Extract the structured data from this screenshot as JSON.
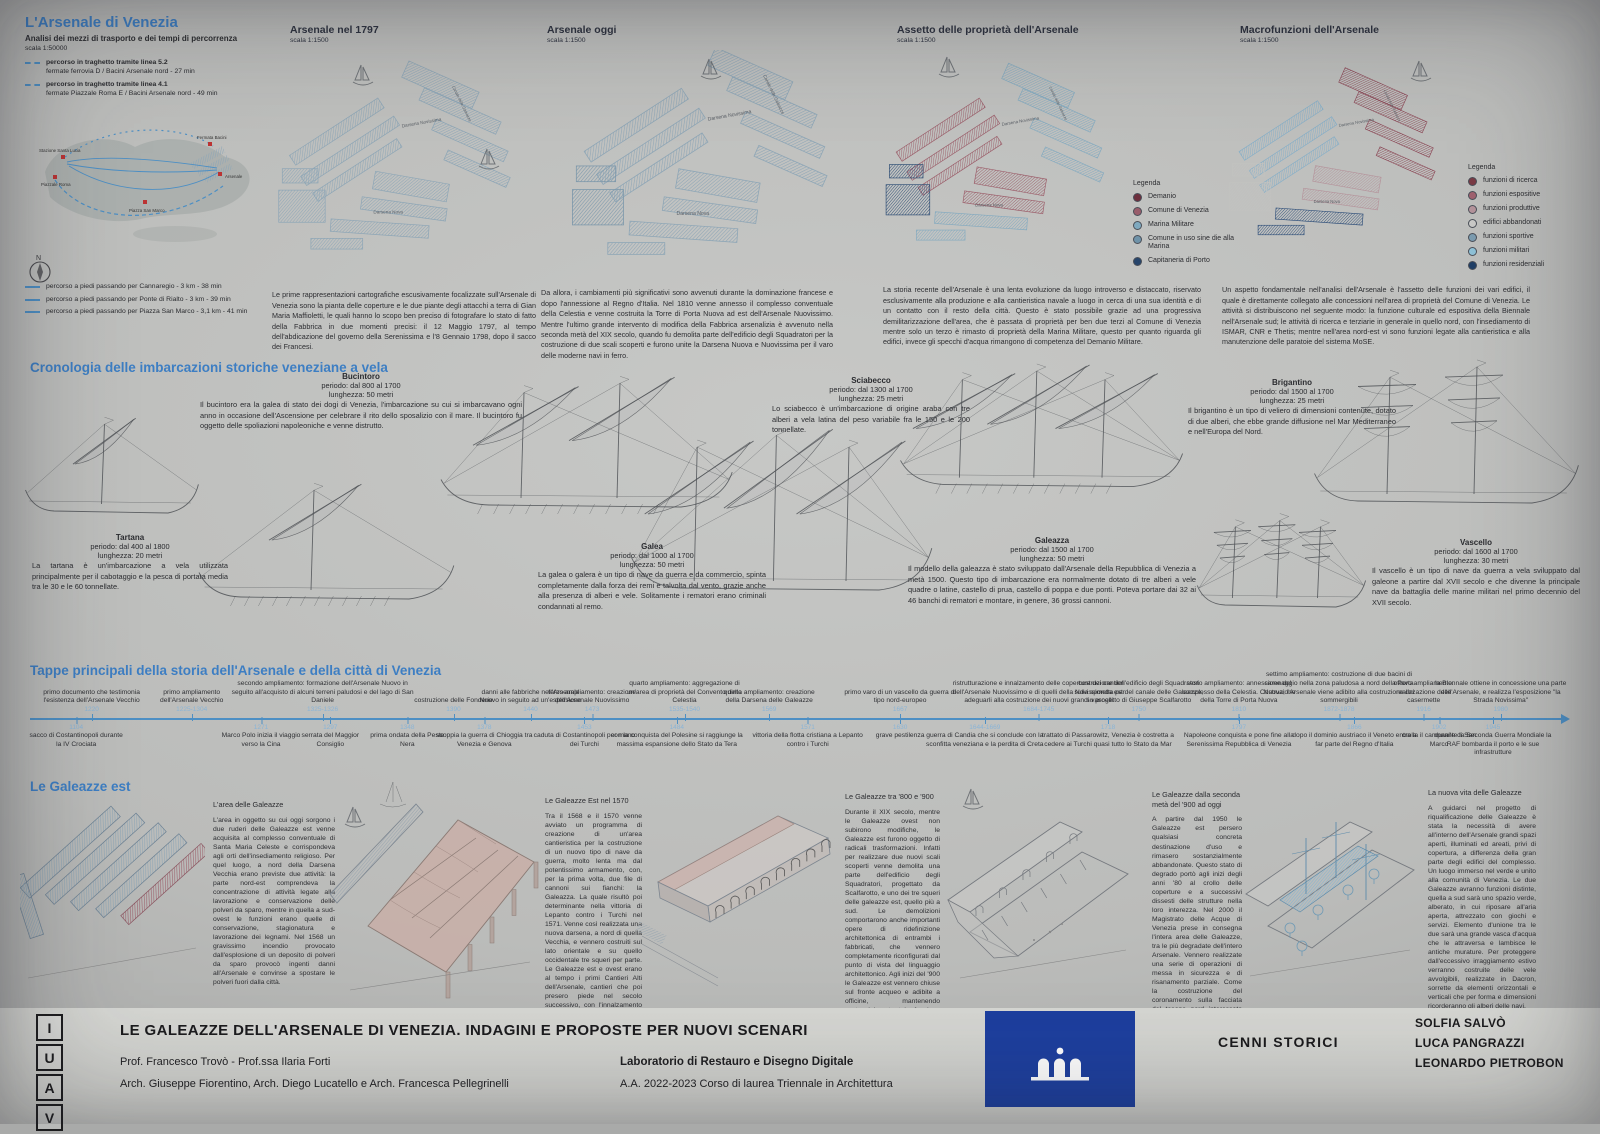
{
  "colors": {
    "accent": "#3d7ec3",
    "timeline": "#4d8fc4",
    "date": "#8ab4d6"
  },
  "transit": {
    "title": "L'Arsenale di Venezia",
    "subtitle": "Analisi dei mezzi di trasporto e dei tempi di percorrenza",
    "scale": "scala 1:50000",
    "ferry_routes": [
      {
        "label": "percorso in traghetto tramite linea 5.2",
        "detail": "fermate ferrovia D / Bacini Arsenale nord - 27 min"
      },
      {
        "label": "percorso in traghetto tramite linea 4.1",
        "detail": "fermate Piazzale Roma E / Bacini Arsenale nord - 49 min"
      }
    ],
    "walk_routes": [
      "percorso a piedi passando per Cannaregio - 3 km - 38 min",
      "percorso a piedi passando per Ponte di Rialto - 3 km - 39 min",
      "percorso a piedi passando per Piazza San Marco - 3,1 km - 41 min"
    ],
    "map_labels": [
      "Stazione Santa Lucia",
      "Piazzale Roma",
      "Piazza San Marco",
      "Fermata Bacini",
      "Arsenale"
    ],
    "compass_label": "N"
  },
  "map_annotations": {
    "water": [
      "Darsena Novissima",
      "Darsena Nova",
      "Canale delle Galeazze"
    ]
  },
  "maps": [
    {
      "title": "Arsenale nel 1797",
      "scale": "scala 1:1500",
      "caption": "Le prime rappresentazioni cartografiche escusivamente focalizzate sull'Arsenale di Venezia sono la pianta delle coperture e le due piante degli attacchi a terra di Gian Maria Maffioletti, le quali hanno lo scopo ben preciso di fotografare lo stato di fatto della Fabbrica in due momenti precisi: il 12 Maggio 1797, al tempo dell'abdicazione del governo della Serenissima e l'8 Gennaio 1798, dopo il sacco dei Francesi."
    },
    {
      "title": "Arsenale oggi",
      "scale": "scala 1:1500",
      "caption": "Da allora, i cambiamenti più significativi sono avvenuti durante la dominazione francese e dopo l'annessione al Regno d'Italia. Nel 1810 venne annesso il complesso conventuale della Celestia e venne costruita la Torre di Porta Nuova ad est dell'Arsenale Nuovissimo. Mentre l'ultimo grande intervento di modifica della Fabbrica arsenalizia è avvenuto nella seconda metà del XIX secolo, quando fu demolita parte dell'edificio degli Squadratori per la costruzione di due scali scoperti e furono unite la Darsena Nuova e Nuovissima per il varo delle moderne navi in ferro."
    },
    {
      "title": "Assetto delle proprietà dell'Arsenale",
      "scale": "scala 1:1500",
      "caption": "La storia recente dell'Arsenale è una lenta evoluzione da luogo introverso e distaccato, riservato esclusivamente alla produzione e alla cantieristica navale a luogo in cerca di una sua identità e di un contatto con il resto della città. Questo è stato possibile grazie ad una progressiva demilitarizzazione dell'area, che è passata di proprietà per ben due terzi al Comune di Venezia mentre solo un terzo è rimasto di proprietà della Marina Militare, questo per quanto riguarda gli edifici, invece gli specchi d'acqua rimangono di competenza del Demanio Militare.",
      "legend": {
        "title": "Legenda",
        "items": [
          {
            "label": "Demanio",
            "color": "#6d2f3d"
          },
          {
            "label": "Comune di Venezia",
            "color": "#995d6b"
          },
          {
            "label": "Marina Militare",
            "color": "#7fa9bf"
          },
          {
            "label": "Comune in uso sine die alla Marina",
            "color": "#6f93a9"
          },
          {
            "label": "Capitaneria di Porto",
            "color": "#27456b"
          }
        ]
      }
    },
    {
      "title": "Macrofunzioni dell'Arsenale",
      "scale": "scala 1:1500",
      "caption": "Un aspetto fondamentale nell'analisi dell'Arsenale è l'assetto delle funzioni dei vari edifici, il quale è direttamente collegato alle concessioni nell'area di proprietà del Comune di Venezia. Le attività si distribuiscono nel seguente modo: la funzione culturale ed espositiva della Biennale nell'Arsenale sud; le attività di ricerca e terziarie in generale in quello nord, con l'insediamento di ISMAR, CNR e Thetis; mentre nell'area nord-est vi sono funzioni legate alla cantieristica e alla manutenzione delle paratoie del sistema MoSE.",
      "legend": {
        "title": "Legenda",
        "items": [
          {
            "label": "funzioni di ricerca",
            "color": "#7a3b45"
          },
          {
            "label": "funzioni espositive",
            "color": "#a0616f"
          },
          {
            "label": "funzioni produttive",
            "color": "#b4939b"
          },
          {
            "label": "edifici abbandonati",
            "color": "#c9c9c7"
          },
          {
            "label": "funzioni sportive",
            "color": "#7b9cb0"
          },
          {
            "label": "funzioni militari",
            "color": "#8fc2d8"
          },
          {
            "label": "funzioni residenziali",
            "color": "#203f66"
          }
        ]
      }
    }
  ],
  "ships_section": {
    "title": "Cronologia delle imbarcazioni storiche veneziane a vela",
    "ships": [
      {
        "name": "Bucintoro",
        "period": "periodo: dal 800 al 1700",
        "length": "lunghezza: 50 metri",
        "desc": "Il bucintoro era la galea di stato dei dogi di Venezia, l'imbarcazione su cui si imbarcavano ogni anno in occasione dell'Ascensione per celebrare il rito dello sposalizio con il mare. Il bucintoro fu oggetto delle spoliazioni napoleoniche e venne distrutto."
      },
      {
        "name": "Sciabecco",
        "period": "periodo: dal 1300 al 1700",
        "length": "lunghezza: 25 metri",
        "desc": "Lo sciabecco è un'imbarcazione di origine araba con tre alberi a vela latina del peso variabile fra le 150 e le 200 tonnellate."
      },
      {
        "name": "Brigantino",
        "period": "periodo: dal 1500 al 1700",
        "length": "lunghezza: 25 metri",
        "desc": "Il brigantino è un tipo di veliero di dimensioni contenute, dotato di due alberi, che ebbe grande diffusione nel Mar Mediterraneo e nell'Europa del Nord."
      },
      {
        "name": "Tartana",
        "period": "periodo: dal 400 al 1800",
        "length": "lunghezza: 20 metri",
        "desc": "La tartana è un'imbarcazione a vela utilizzata principalmente per il cabotaggio e la pesca di portata media tra le 30 e le 60 tonnellate."
      },
      {
        "name": "Galea",
        "period": "periodo: dal 1000 al 1700",
        "length": "lunghezza: 50 metri",
        "desc": "La galea o galera è un tipo di nave da guerra e da commercio, spinta completamente dalla forza dei remi e talvolta dal vento, grazie anche alla presenza di alberi e vele. Solitamente i rematori erano criminali condannati al remo."
      },
      {
        "name": "Galeazza",
        "period": "periodo: dal 1500 al 1700",
        "length": "lunghezza: 50 metri",
        "desc": "Il modello della galeazza è stato sviluppato dall'Arsenale della Repubblica di Venezia a metà 1500. Questo tipo di imbarcazione era normalmente dotato di tre alberi a vele quadre o latine, castello di prua, castello di poppa e due ponti. Poteva portare dai 32 ai 46 banchi di rematori e montare, in genere, 36 grossi cannoni."
      },
      {
        "name": "Vascello",
        "period": "periodo: dal 1600 al 1700",
        "length": "lunghezza: 30 metri",
        "desc": "Il vascello è un tipo di nave da guerra a vela sviluppato dal galeone a partire dal XVII secolo e che divenne la principale nave da battaglia delle marine militari nel primo decennio del XVII secolo."
      }
    ]
  },
  "timeline": {
    "title": "Tappe principali della storia dell'Arsenale e della città di Venezia",
    "events_above": [
      {
        "date": "1220",
        "label": "primo documento che testimonia l'esistenza dell'Arsenale Vecchio",
        "x_pct": 4,
        "w": 100
      },
      {
        "date": "1225-1304",
        "label": "primo ampliamento dell'Arsenale Vecchio",
        "x_pct": 10.5,
        "w": 80
      },
      {
        "date": "1325-1326",
        "label": "secondo ampliamento: formazione dell'Arsenale Nuovo in seguito all'acquisto di alcuni terreni paludosi e del lago di San Daniele",
        "x_pct": 19,
        "w": 190
      },
      {
        "date": "1390",
        "label": "costruzione delle Fonderie",
        "x_pct": 27.5,
        "w": 80
      },
      {
        "date": "1440",
        "label": "danni alle fabbriche nell'Arsenale Nuovo in seguito ad un'esplosione",
        "x_pct": 32.5,
        "w": 110
      },
      {
        "date": "1473",
        "label": "terzo ampliamento: creazione dell'Arsenale Nuovissimo",
        "x_pct": 36.5,
        "w": 95
      },
      {
        "date": "1535-1540",
        "label": "quarto ampliamento: aggregazione di un'area di proprietà del Convento della Celestia",
        "x_pct": 42.5,
        "w": 130
      },
      {
        "date": "1569",
        "label": "quinto ampliamento: creazione della Darsena delle Galeazze",
        "x_pct": 48,
        "w": 100
      },
      {
        "date": "1667",
        "label": "primo varo di un vascello da guerra di tipo nord-europeo",
        "x_pct": 56.5,
        "w": 120
      },
      {
        "date": "1684-1745",
        "label": "ristrutturazione e innalzamento delle coperture dei cantieri dell'Arsenale Nuovissimo e di quelli della Novissimetta per adeguarli alla costruzione dei nuovi grandi vascelli",
        "x_pct": 65.5,
        "w": 175
      },
      {
        "date": "1750",
        "label": "costruzione dell'edificio degli Squadratori sulla sponda est del canale delle Galeazze, su progetto di Giuseppe Scalfarotto",
        "x_pct": 72,
        "w": 135
      },
      {
        "date": "1810",
        "label": "sesto ampliamento: annessione del complesso della Celestia. Costruzione della Torre di Porta Nuova",
        "x_pct": 78.5,
        "w": 115
      },
      {
        "date": "1872-1878",
        "label": "settimo ampliamento: costruzione di due bacini di carenaggio nella zona paludosa a nord della Porta Nuova; l'Arsenale viene adibito alla costruzione dei sommergibili",
        "x_pct": 85,
        "w": 155
      },
      {
        "date": "1916",
        "label": "ottavo ampliamento: realizzazione delle casermette",
        "x_pct": 90.5,
        "w": 85
      },
      {
        "date": "1980",
        "label": "la Biennale ottiene in concessione una parte dell'Arsenale, e realizza l'esposizione \"la Strada Novissima\"",
        "x_pct": 95.5,
        "w": 140
      }
    ],
    "events_below": [
      {
        "date": "1104",
        "label": "sacco di Costantinopoli durante la IV Crociata",
        "x_pct": 3,
        "w": 95
      },
      {
        "date": "1271",
        "label": "Marco Polo inizia il viaggio verso la Cina",
        "x_pct": 15,
        "w": 85
      },
      {
        "date": "1297",
        "label": "serrata del Maggior Consiglio",
        "x_pct": 19.5,
        "w": 70
      },
      {
        "date": "1348",
        "label": "prima ondata della Peste Nera",
        "x_pct": 24.5,
        "w": 75
      },
      {
        "date": "1378",
        "label": "scoppia la guerra di Chioggia tra Venezia e Genova",
        "x_pct": 29.5,
        "w": 115
      },
      {
        "date": "1453",
        "label": "caduta di Costantinopoli per mano dei Turchi",
        "x_pct": 36,
        "w": 110
      },
      {
        "date": "1484",
        "label": "con la conquista del Polesine si raggiunge la massima espansione dello Stato da Tera",
        "x_pct": 42,
        "w": 150
      },
      {
        "date": "1571",
        "label": "vittoria della flotta cristiana a Lepanto contro i Turchi",
        "x_pct": 50.5,
        "w": 115
      },
      {
        "date": "1630",
        "label": "grave pestilenza",
        "x_pct": 56.5,
        "w": 60
      },
      {
        "date": "1644-1669",
        "label": "guerra di Candia che si conclude con la sconfitta veneziana e la perdita di Creta",
        "x_pct": 62,
        "w": 140
      },
      {
        "date": "1718",
        "label": "trattato di Passarowitz, Venezia è costretta a cedere ai Turchi quasi tutto lo Stato da Mar",
        "x_pct": 70,
        "w": 140
      },
      {
        "date": "1797",
        "label": "Napoleone conquista e pone fine alla Serenissima Repubblica di Venezia",
        "x_pct": 78.5,
        "w": 130
      },
      {
        "date": "1866",
        "label": "dopo il dominio austriaco il Veneto entra a far parte del Regno d'Italia",
        "x_pct": 86,
        "w": 130
      },
      {
        "date": "1902",
        "label": "crolla il campanile di San Marco",
        "x_pct": 91.5,
        "w": 75
      },
      {
        "date": "1945",
        "label": "durante la Seconda Guerra Mondiale la RAF bombarda il porto e le sue infrastrutture",
        "x_pct": 95,
        "w": 130
      }
    ]
  },
  "galeazze": {
    "title": "Le Galeazze est",
    "columns": [
      {
        "heading": "L'area delle Galeazze",
        "text": "L'area in oggetto su cui oggi sorgono i due ruderi delle Galeazze est venne acquisita al complesso conventuale di Santa Maria Celeste e corrispondeva agli orti dell'insediamento religioso. Per quel luogo, a nord della Darsena Vecchia erano previste due attività: la parte nord-est comprendeva la concentrazione di attività legate alla lavorazione e conservazione delle polveri da sparo, mentre in quella a sud-ovest le funzioni erano quelle di conservazione, stagionatura e lavorazione dei legnami. Nel 1568 un gravissimo incendio provocato dall'esplosione di un deposito di polveri da sparo provocò ingenti danni all'Arsenale e convinse a spostare le polveri fuori dalla città."
      },
      {
        "heading": "Le Galeazze Est nel 1570",
        "text": "Tra il 1568 e il 1570 venne avviato un programma di creazione di un'area cantieristica per la costruzione di un nuovo tipo di nave da guerra, molto lenta ma dal potentissimo armamento, con, per la prima volta, due file di cannoni sui fianchi: la Galeazza. La quale risultò poi determinante nella vittoria di Lepanto contro i Turchi nel 1571. Venne così realizzata una nuova darsena, a nord di quella Vecchia, e vennero costruiti sul lato orientale e su quello occidentale tre squeri per parte. Le Galeazze est e ovest erano al tempo i primi Cantieri Alti dell'Arsenale, cantieri che poi presero piede nel secolo successivo, con l'innalzamento dei cantieri esistenti per adattarli alla costruzione dei moderni Vascelli."
      },
      {
        "heading": "Le Galeazze tra '800 e '900",
        "text": "Durante il XIX secolo, mentre le Galeazze ovest non subirono modifiche, le Galeazze est furono oggetto di radicali trasformazioni. Infatti per realizzare due nuovi scali scoperti venne demolita una parte dell'edificio degli Squadratori, progettato da Scalfarotto, e uno dei tre squeri delle galeazze est, quello più a sud. Le demolizioni comportarono anche importanti opere di ridefinizione architettonica di entrambi i fabbricati, che vennero completamente riconfigurati dal punto di vista del linguaggio architettonico. Agli inizi del '900 le Galeazze est vennero chiuse sul fronte acqueo e adibite a officine, mantenendo sostanzialmente tale funzione fino alla metà del secolo scorso."
      },
      {
        "heading": "Le Galeazze dalla seconda metà del '900 ad oggi",
        "text": "A partire dal 1950 le Galeazze est persero qualsiasi concreta destinazione d'uso e rimasero sostanzialmente abbandonate. Questo stato di degrado portò agli inizi degli anni '80 al crollo delle coperture e a successivi dissesti delle strutture nella loro interezza. Nel 2000 il Magistrato delle Acque di Venezia prese in consegna l'intera area delle Galeazze, tra le più degradate dell'intero Arsenale. Vennero realizzate una serie di operazioni di messa in sicurezza e di risanamento parziale. Come la costruzione del coronamento sulla facciata del tesone nord interessato dal crollo, la ricomposizione e il consolidamento del perimetro murario di gronda e opere di puntellamento delle facciate."
      },
      {
        "heading": "La nuova vita delle Galeazze",
        "text": "A guidarci nel progetto di riqualificazione delle Galeazze è stata la necessità di avere all'interno dell'Arsenale grandi spazi aperti, illuminati ed areati, privi di copertura, a differenza della gran parte degli edifici del complesso. Un luogo immerso nel verde e unito alla comunità di Venezia. Le due Galeazze avranno funzioni distinte, quella a sud sarà uno spazio verde, alberato, in cui riposare all'aria aperta, attrezzato con giochi e servizi. Elemento d'unione tra le due sarà una grande vasca d'acqua che le attraversa e lambisce le antiche murature. Per proteggere dall'eccessivo irraggiamento estivo verranno costruite delle vele avvolgibili, realizzate in Dacron, sorrette da elementi orizzontali e verticali che per forma e dimensioni ricorderanno gli alberi delle navi."
      }
    ]
  },
  "footer": {
    "logo_letters": [
      "I",
      "U",
      "A",
      "V"
    ],
    "title": "LE GALEAZZE DELL'ARSENALE DI VENEZIA. INDAGINI E PROPOSTE PER NUOVI SCENARI",
    "professors": "Prof. Francesco Trovò - Prof.ssa Ilaria Forti",
    "architects": "Arch. Giuseppe Fiorentino, Arch. Diego Lucatello e Arch. Francesca Pellegrinelli",
    "lab": "Laboratorio di Restauro e Disegno Digitale",
    "course": "A.A. 2022-2023 Corso di laurea Triennale in Architettura",
    "section_tag": "CENNI STORICI",
    "authors": [
      "SOLFIA SALVÒ",
      "LUCA PANGRAZZI",
      "LEONARDO PIETROBON"
    ]
  }
}
